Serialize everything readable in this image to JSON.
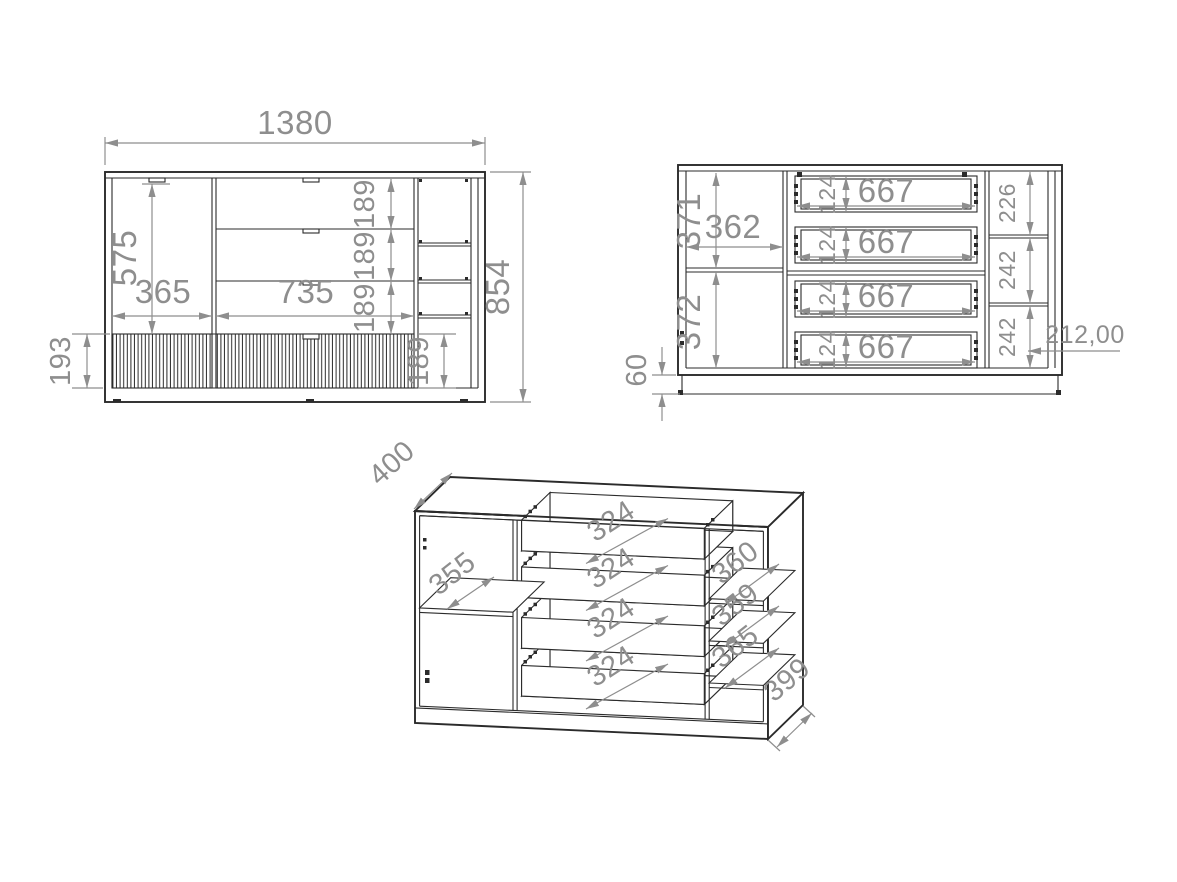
{
  "colors": {
    "background": "#ffffff",
    "drawing_line": "#2b2b2b",
    "dimension": "#8e8e8e"
  },
  "front_view": {
    "total_width": "1380",
    "total_height": "854",
    "door_height": "575",
    "door_width": "365",
    "drawer_section_width": "735",
    "drawer_heights": [
      "189",
      "189",
      "189"
    ],
    "bottom_drawer_height": "193",
    "right_bottom_cell_height": "189"
  },
  "internal_view": {
    "upper_compartment_height": "371",
    "compartment_width": "362",
    "lower_compartment_height": "372",
    "plinth_height": "60",
    "drawers": [
      {
        "width": "667",
        "height": "124"
      },
      {
        "width": "667",
        "height": "124"
      },
      {
        "width": "667",
        "height": "124"
      },
      {
        "width": "667",
        "height": "124"
      }
    ],
    "right_cell_heights": [
      "226",
      "242",
      "242"
    ],
    "right_section_width": "212,00"
  },
  "isometric_view": {
    "depth": "400",
    "left_shelf_depth": "355",
    "drawer_depths": [
      "324",
      "324",
      "324",
      "324"
    ],
    "right_shelf_depths": [
      "360",
      "359",
      "365"
    ],
    "side_depth": "399"
  }
}
